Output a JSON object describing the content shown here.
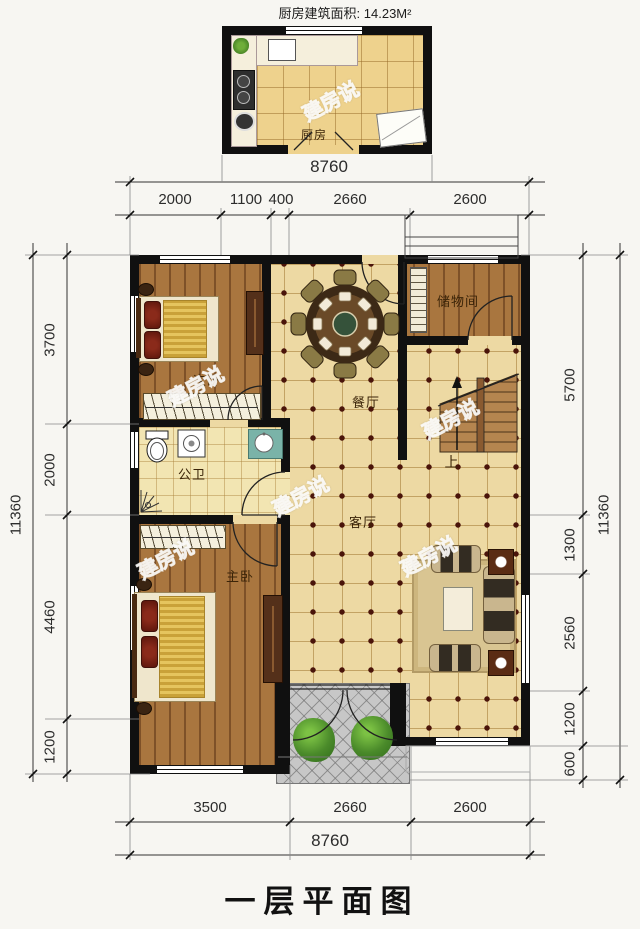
{
  "title": "一层平面图",
  "watermark": "建房说",
  "kitchen": {
    "area_label": "厨房建筑面积: 14.23M²",
    "room_label": "厨房",
    "width_dim": "8760"
  },
  "rooms": {
    "secondary_bedroom": "次卧",
    "storage_room": "储物间",
    "dining_room": "餐厅",
    "bathroom": "公卫",
    "master_bedroom": "主卧",
    "living_room": "客厅",
    "stairs_up": "上"
  },
  "dims": {
    "top": [
      "2000",
      "1100",
      "400",
      "2660",
      "2600"
    ],
    "bottom": [
      "3500",
      "2660",
      "2600"
    ],
    "bottom_total": "8760",
    "left": [
      "3700",
      "2000",
      "4460",
      "1200"
    ],
    "left_total": "11360",
    "right": [
      "5700",
      "1300",
      "2560",
      "1200",
      "600"
    ],
    "right_total": "11360"
  },
  "colors": {
    "wall": "#101010",
    "tile_floor": "#edd9a3",
    "wood_floor": "#a4713d",
    "tile_dot": "#4a140a",
    "porch": "#c7c7c7",
    "vanity": "#7ab3a8"
  }
}
